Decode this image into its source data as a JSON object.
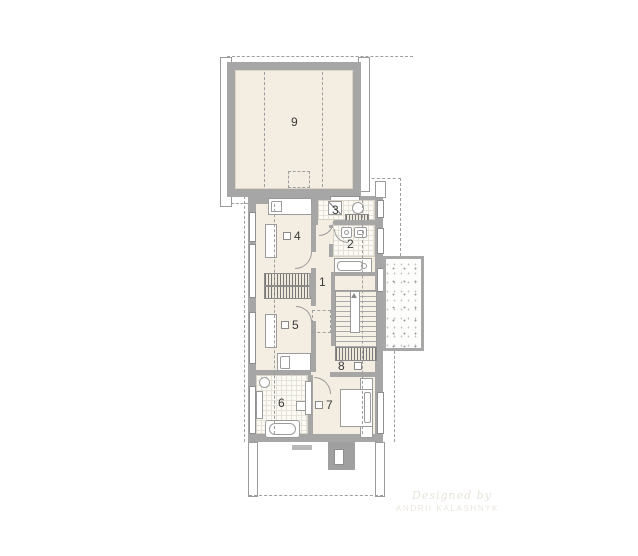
{
  "plan": {
    "type": "architectural floor plan",
    "watermark": {
      "line1": "Designed by",
      "line2": "ANDRII KALASHNYK"
    }
  },
  "rooms": [
    {
      "number": "1"
    },
    {
      "number": "2"
    },
    {
      "number": "3"
    },
    {
      "number": "4"
    },
    {
      "number": "5"
    },
    {
      "number": "6"
    },
    {
      "number": "7"
    },
    {
      "number": "8"
    },
    {
      "number": "9"
    }
  ],
  "colors": {
    "wall": "#a6a6a6",
    "floor": "#f4ede1",
    "tile": "#fbfaf5",
    "line": "#9b9b9b",
    "label": "#3a3a3a"
  }
}
